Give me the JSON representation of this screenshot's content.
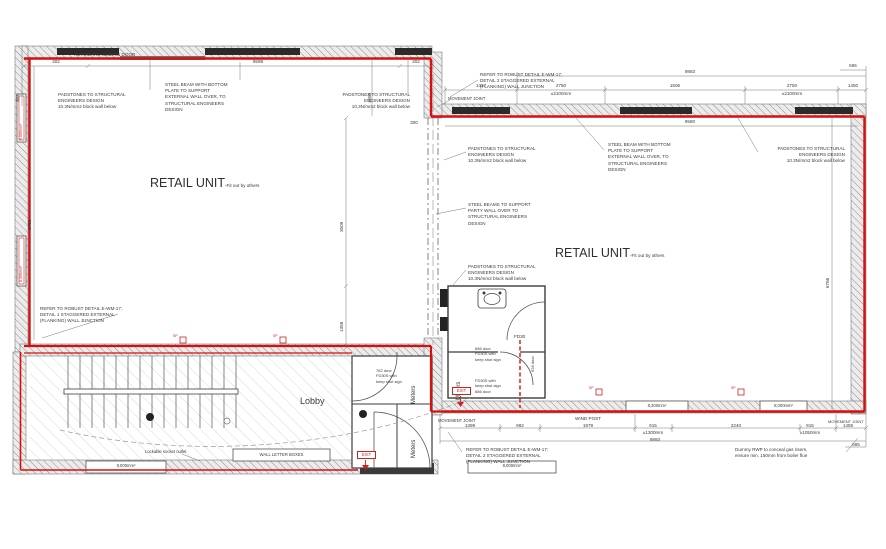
{
  "colors": {
    "fire_line": "#d60f0f",
    "wall_hatch": "#8f8f8f",
    "ink": "#3a3a3a",
    "red_label": "#cc2222"
  },
  "rooms": {
    "retail_name": "RETAIL UNIT",
    "retail_suffix": "-Fit out by others",
    "lobby": "Lobby",
    "meters": "Meters",
    "wc_door_rating": "FD30"
  },
  "notes": {
    "auto_sliding_door": "AUTOMATIC SLIDING DOOR",
    "padstones": "PADSTONES TO STRUCTURAL\nENGINEERS DESIGN\n10.3N/mm2 block wall below",
    "steel_beam": "STEEL BEAM WITH BOTTOM\nPLATE TO SUPPORT\nEXTERNAL WALL OVER, TO\nSTRUCTURAL ENGINEERS\nDESIGN",
    "steel_beams_party": "STEEL BEAMS TO SUPPORT\nPARTY WALL OVER TO\nSTRUCTURAL ENGINEERS\nDESIGN",
    "robust_detail_1": "REFER TO ROBUST DETAIL E-WM-17;\nDETAIL 1 STAGGERED EXTERNAL\n(FLANKING) WALL JUNCTION",
    "robust_detail_2": "REFER TO ROBUST DETAIL E-WM-17;\nDETAIL 2 STAGGERED EXTERNAL\n(FLANKING) WALL JUNCTION",
    "movement_joint": "MOVEMENT JOINT",
    "wind_post": "WIND POST",
    "lockable_socket": "Lockable socket outlet",
    "wall_letter_boxes": "WALL LETTER BOXES",
    "dummy_rwp": "Dummy RWP to conceal gas risers,\nensure min. 150mm from boiler flue",
    "exit": "EXIT",
    "socket": "SP",
    "door_686_a": "686 door\nFD30S with\nkeep shut sign",
    "door_686_b": "FD30S with\nkeep shut sign\n686 door",
    "door_628": "628 door",
    "door_762": "762 door\nFD30S with\nkeep shut sign"
  },
  "vents": {
    "v8000": "8,000mm²",
    "v8300": "8,300mm²"
  },
  "dims": {
    "n302": "302",
    "n300": "300",
    "n9598": "9598",
    "n1586": "1586",
    "n1427": "1427",
    "n2750": "2750",
    "pm2100": "±2100mm",
    "n1506": "1506",
    "n1450": "1450",
    "n9883": "9883",
    "n665": "665",
    "n9580": "9580",
    "n3509": "3509",
    "n1358": "1358",
    "n6768": "6768",
    "n6766": "6766",
    "n1399": "1399",
    "n992": "992",
    "n1979": "1979",
    "n915": "915",
    "pm1300": "±1300mm",
    "n9893": "9893",
    "n2240": "2240",
    "pm1050": "±1050mm",
    "n1459": "1459"
  }
}
